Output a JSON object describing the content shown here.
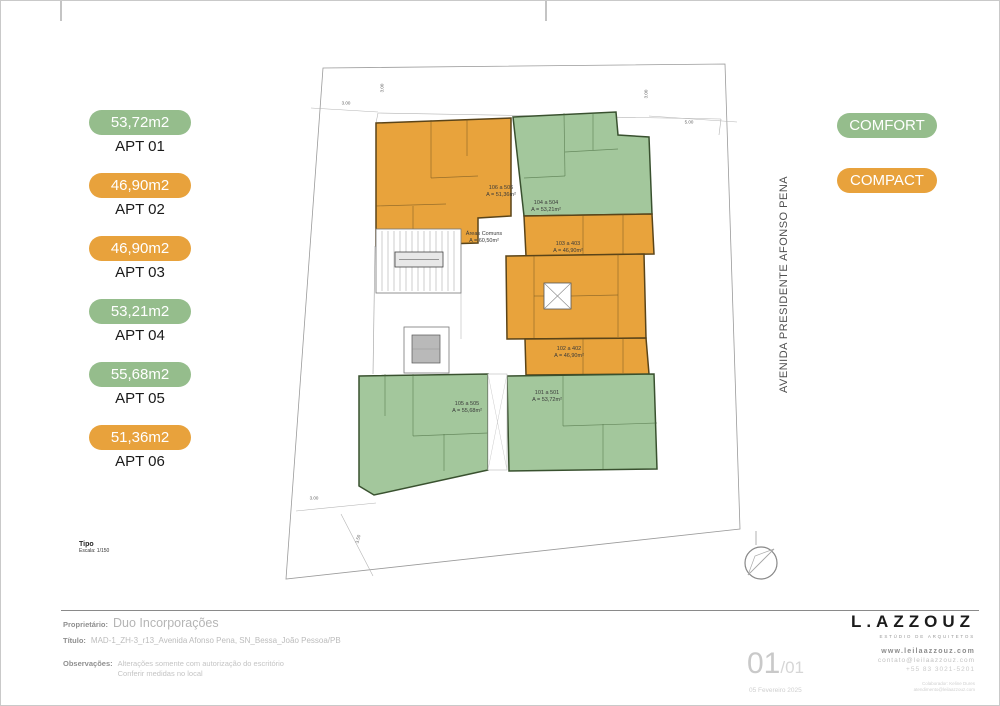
{
  "legend": {
    "apartments": [
      {
        "area": "53,72m2",
        "label": "APT 01",
        "type": "comfort"
      },
      {
        "area": "46,90m2",
        "label": "APT 02",
        "type": "compact"
      },
      {
        "area": "46,90m2",
        "label": "APT 03",
        "type": "compact"
      },
      {
        "area": "53,21m2",
        "label": "APT 04",
        "type": "comfort"
      },
      {
        "area": "55,68m2",
        "label": "APT 05",
        "type": "comfort"
      },
      {
        "area": "51,36m2",
        "label": "APT 06",
        "type": "compact"
      }
    ],
    "types": [
      {
        "label": "COMFORT",
        "color": "#95BD8C"
      },
      {
        "label": "COMPACT",
        "color": "#E8A23C"
      }
    ]
  },
  "colors": {
    "comfort_badge": "#95BD8C",
    "compact_badge": "#E8A23C",
    "plan_comfort_fill": "#A3C79C",
    "plan_compact_fill": "#E8A33C"
  },
  "street": {
    "label": "AVENIDA PRESIDENTE AFONSO PENA"
  },
  "plan": {
    "scale_title": "Tipo",
    "scale": "Escala: 1/150",
    "common_area": {
      "name": "Áreas Comuns",
      "area": "A = 60,50m²"
    },
    "units": [
      {
        "id": "106 a 506",
        "area": "A = 51,36m²",
        "type": "compact"
      },
      {
        "id": "104 a 504",
        "area": "A = 53,21m²",
        "type": "comfort"
      },
      {
        "id": "103 a 403",
        "area": "A = 46,90m²",
        "type": "compact"
      },
      {
        "id": "102 a 402",
        "area": "A = 46,90m²",
        "type": "compact"
      },
      {
        "id": "101 a 501",
        "area": "A = 53,72m²",
        "type": "comfort"
      },
      {
        "id": "105 a 505",
        "area": "A = 55,68m²",
        "type": "comfort"
      }
    ],
    "dimensions": {
      "top_left_h": "3.00",
      "top_left_v": "3.00",
      "top_right_v": "3.00",
      "right_h": "5.00",
      "bottom_left_h": "3.00",
      "bottom_left_d": "3.50"
    }
  },
  "footer": {
    "owner_label": "Proprietário:",
    "owner": "Duo Incorporações",
    "title_label": "Título:",
    "title": "MAD-1_ZH-3_r13_Avenida Afonso Pena, SN_Bessa_João Pessoa/PB",
    "notes_label": "Observações:",
    "notes_line1": "Alterações somente com autorização do escritório",
    "notes_line2": "Conferir medidas no local",
    "page_current": "01",
    "page_total": "/01",
    "date": "05 Fevereiro 2025",
    "brand": "L.AZZOUZ",
    "brand_sub": "ESTÚDIO DE ARQUITETOS",
    "website": "www.leilaazzouz.com",
    "email": "contato@leilaazzouz.com",
    "phone": "+55 83 3021-5201",
    "tiny_line1": "Colaborador: Keline Dures",
    "tiny_line2": "atendimento@leilaazzouz.com"
  }
}
